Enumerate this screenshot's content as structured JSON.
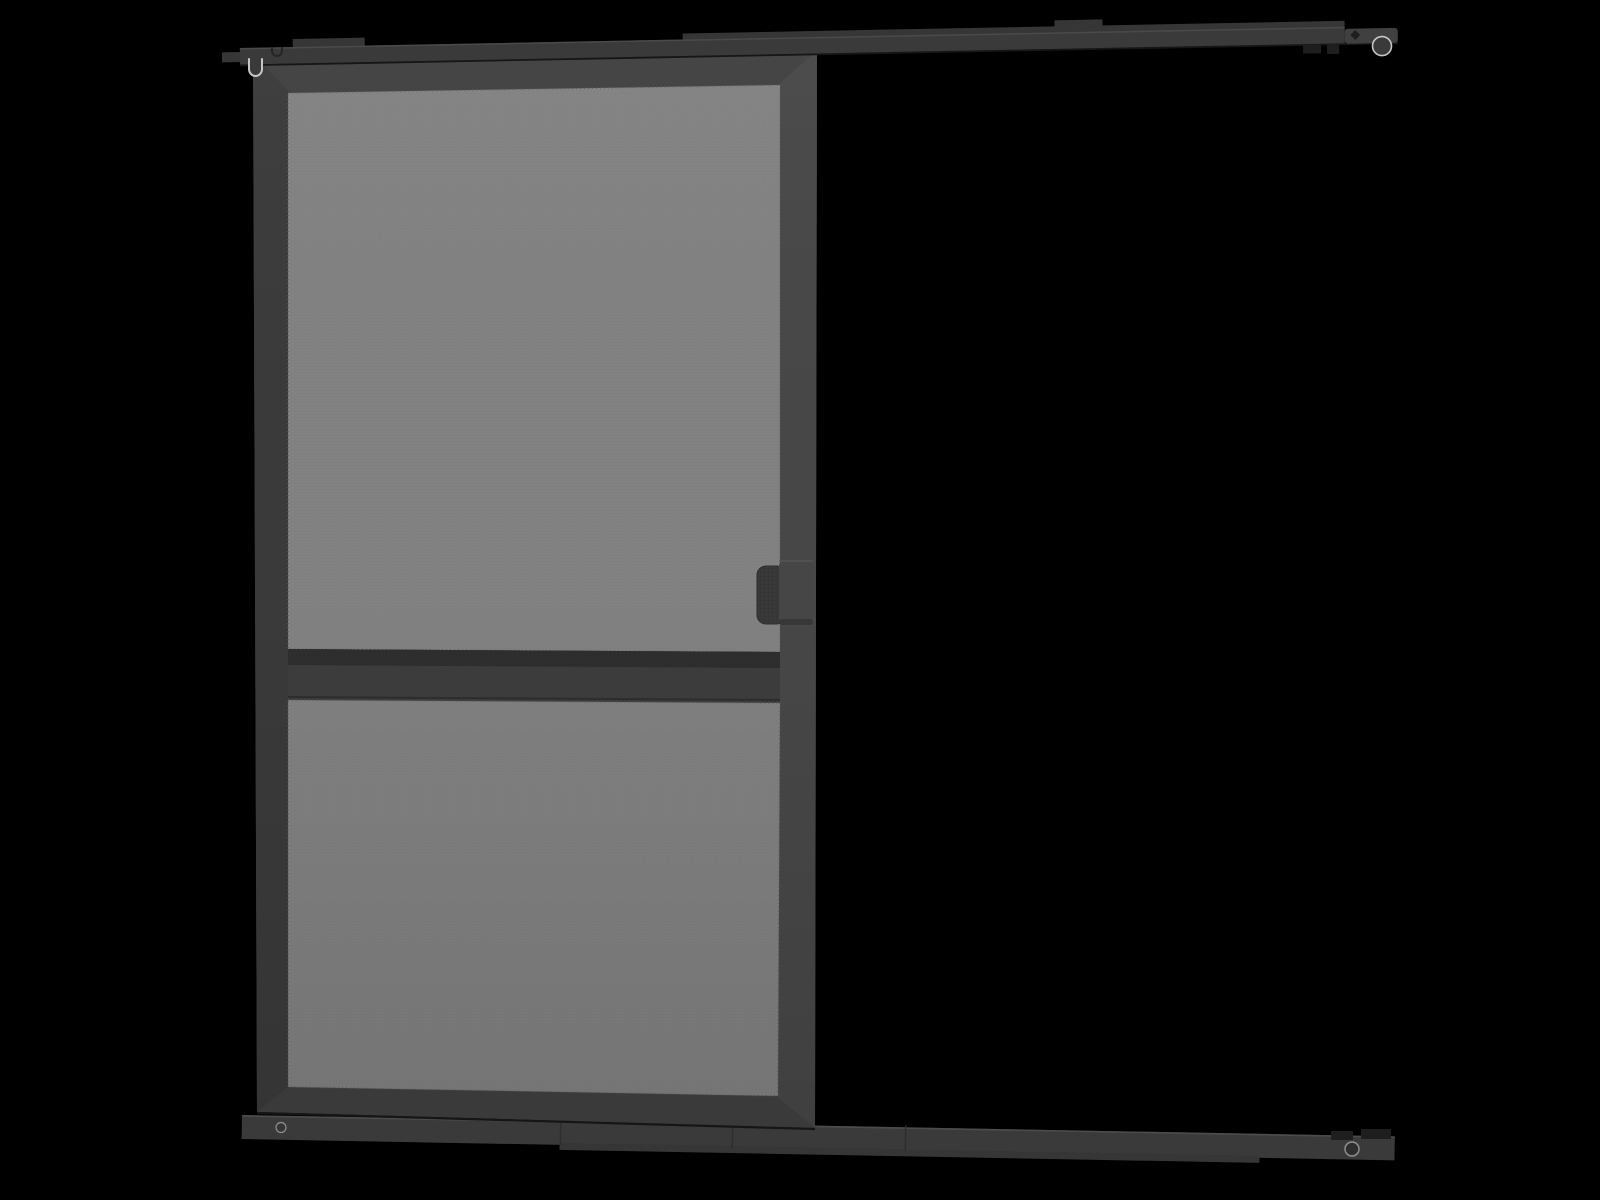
{
  "scene": {
    "description": "3D product render of a dark grey sliding insect-screen door hanging from a top mounting track, with a bottom guide track, on a black background",
    "background": "#000000"
  },
  "colors": {
    "background": "#000000",
    "frame": "#404040",
    "frame_left": "#3a3a3a",
    "frame_right": "#474747",
    "rail_mid": "#3d3d3d",
    "rail_shadow": "#2e2e2e",
    "mesh": "#828282",
    "mesh_grid": "#6d6d6d",
    "mesh_edge": "#5a5a5a",
    "track": "#3a3a3a",
    "track_back": "#363636",
    "track_light": "#515151",
    "track_dark": "#161616",
    "handle_plate": "#464646",
    "handle_grip": "#393939",
    "grip_grid": "#2d2d2d",
    "ring_light": "#c7c7c7",
    "screw_ring": "#8f8f8f",
    "hardware": "#1e1e1e"
  },
  "parts": {
    "top_track": {
      "label": "Top mounting track rail"
    },
    "top_track_end_roller": {
      "label": "Top track end roller"
    },
    "hanger_hook": {
      "label": "Roller hanger hook"
    },
    "door": {
      "label": "Sliding screen door panel"
    },
    "mesh_upper": {
      "label": "Upper mesh screen panel"
    },
    "mesh_lower": {
      "label": "Lower mesh screen panel"
    },
    "mid_rail": {
      "label": "Middle cross rail"
    },
    "handle": {
      "label": "Pull handle"
    },
    "bottom_track": {
      "label": "Bottom guide track rail"
    },
    "screw_left": {
      "label": "Bottom track screw"
    },
    "screw_right": {
      "label": "Bottom track screw"
    }
  }
}
